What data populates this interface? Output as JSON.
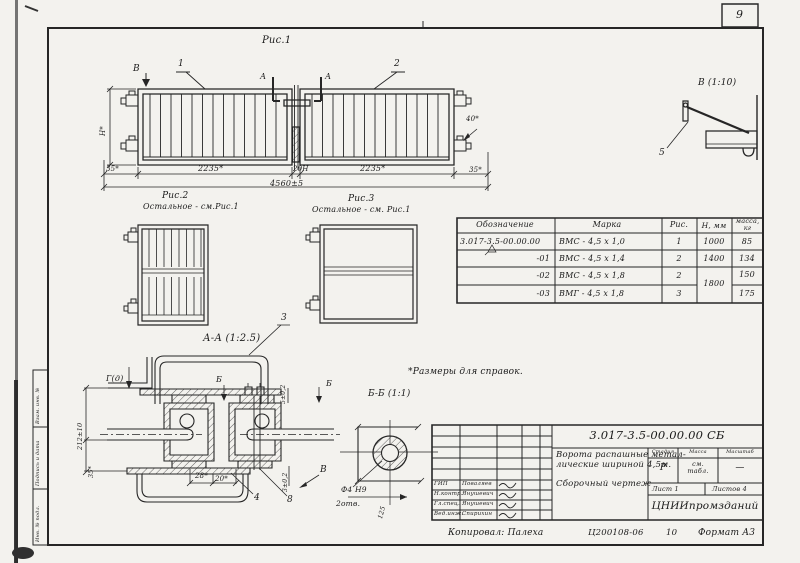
{
  "page": {
    "number": "9",
    "copied_by": "Копировал: Палеха",
    "doc_code": "Ц200108-06",
    "doc_code2": "10",
    "format": "Формат А3"
  },
  "side_stamp": {
    "cells": [
      "Взам. инв. №",
      "Подпись и дата",
      "Инв. № подл."
    ]
  },
  "figures": {
    "fig1": {
      "title": "Рис.1",
      "view_b": "В",
      "section_a": "А",
      "callout_1": "1",
      "callout_2": "2",
      "dim_height": "Н*",
      "dim_35_left": "35*",
      "dim_leaf_left": "2235*",
      "dim_gap": "20Н",
      "dim_leaf_right": "2235*",
      "dim_35_right": "35*",
      "dim_total": "4560±5",
      "dim_40": "40*"
    },
    "fig2": {
      "title": "Рис.2",
      "note": "Остальное - см.Рис.1"
    },
    "fig3": {
      "title": "Рис.3",
      "note": "Остальное - см. Рис.1"
    },
    "detail_aa": {
      "title": "А-А (1:2.5)",
      "label_g": "Г(д)",
      "label_b_left": "Б",
      "label_b_right": "Б",
      "dim_5": "5±0,2",
      "dim_3": "3±0,2",
      "dim_28": "28*",
      "dim_20": "20*",
      "dim_212": "212±10",
      "dim_35": "35*",
      "callout_3": "3",
      "callout_4": "4",
      "callout_8": "8",
      "callout_v": "В"
    },
    "detail_bb": {
      "title": "Б-Б (1:1)",
      "dim_hole": "Ф4 Н9",
      "dim_holes": "2отв.",
      "dim_len": "125"
    },
    "detail_v": {
      "title": "В (1:10)",
      "callout_5": "5"
    },
    "note": "*Размеры для справок."
  },
  "spec_table": {
    "headers": [
      "Обозначение",
      "Марка",
      "Рис.",
      "Н, мм",
      "масса, кг"
    ],
    "rows": [
      {
        "designation": "3.017-3.5-00.00.00",
        "mark": "ВМС - 4,5 х 1,0",
        "fig": "1",
        "h": "1000",
        "mass": "85"
      },
      {
        "designation": "-01",
        "mark": "ВМС - 4,5 х 1,4",
        "fig": "2",
        "h": "1400",
        "mass": "134"
      },
      {
        "designation": "-02",
        "mark": "ВМС - 4,5 х 1,8",
        "fig": "2",
        "h": "1800",
        "mass": "150"
      },
      {
        "designation": "-03",
        "mark": "ВМГ - 4,5 х 1,8",
        "fig": "3",
        "h": "",
        "mass": "175"
      }
    ]
  },
  "title_block": {
    "doc_number": "3.017-3.5-00.00.00 СБ",
    "title_line1": "Ворота распашные метал-",
    "title_line2": "лические шириной 4,5м.",
    "title_line3": "Сборочный чертеж",
    "stage_h": "Стадия",
    "mass_h": "Масса",
    "scale_h": "Масштаб",
    "stage": "Р",
    "mass": "см. табл.",
    "scale": "—",
    "sheet": "Лист 1",
    "sheets": "Листов 4",
    "org": "ЦНИИпромзданий",
    "roles": [
      {
        "role": "ГИП",
        "name": "Поваляев"
      },
      {
        "role": "Н.контр.",
        "name": "Янушевич"
      },
      {
        "role": "Гл.спец.",
        "name": "Янушевич"
      },
      {
        "role": "Вед.инж.",
        "name": "Спирихин"
      }
    ]
  }
}
